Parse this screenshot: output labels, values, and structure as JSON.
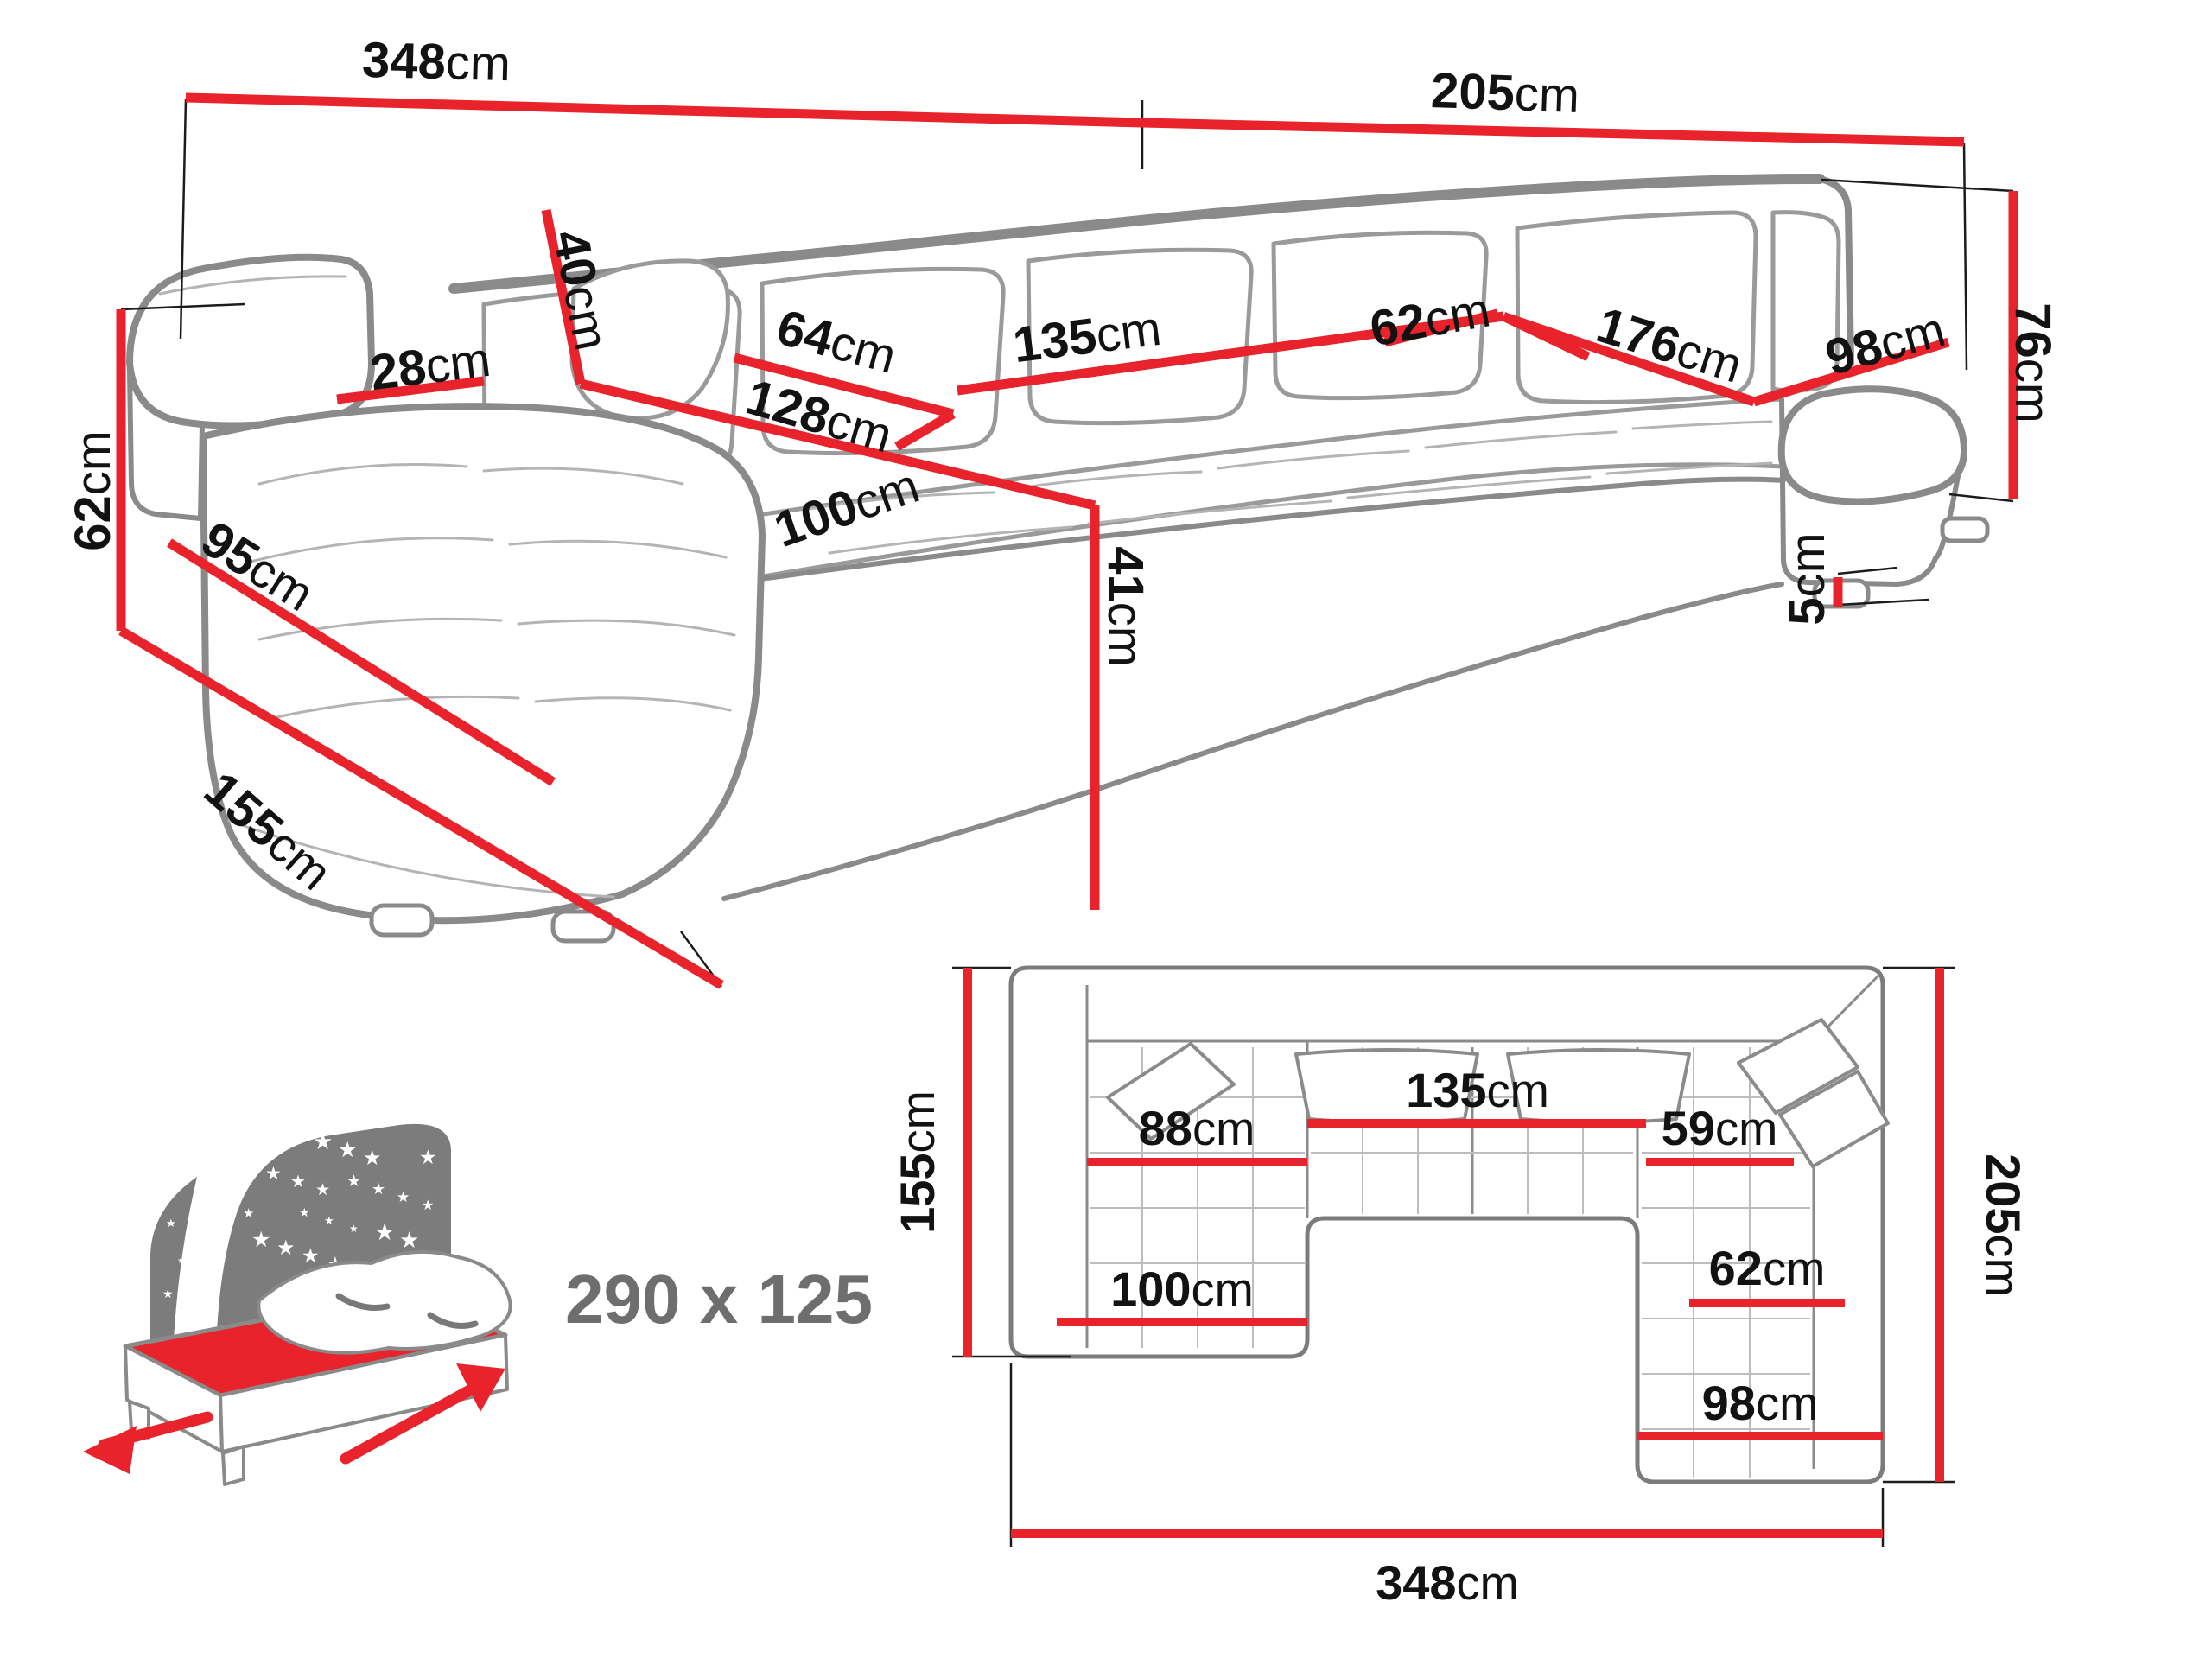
{
  "diagram": {
    "type": "corner-sofa-dimension-diagram",
    "accent_color": "#e8232b",
    "sketch_color": "#8a8a8a",
    "perspective": {
      "dims": [
        {
          "v": "348",
          "u": "cm"
        },
        {
          "v": "205",
          "u": "cm"
        },
        {
          "v": "76",
          "u": "cm"
        },
        {
          "v": "62",
          "u": "cm"
        },
        {
          "v": "95",
          "u": "cm"
        },
        {
          "v": "155",
          "u": "cm"
        },
        {
          "v": "28",
          "u": "cm"
        },
        {
          "v": "40",
          "u": "cm"
        },
        {
          "v": "64",
          "u": "cm"
        },
        {
          "v": "128",
          "u": "cm"
        },
        {
          "v": "135",
          "u": "cm"
        },
        {
          "v": "100",
          "u": "cm"
        },
        {
          "v": "41",
          "u": "cm"
        },
        {
          "v": "176",
          "u": "cm"
        },
        {
          "v": "62",
          "u": "cm"
        },
        {
          "v": "98",
          "u": "cm"
        },
        {
          "v": "5",
          "u": "cm"
        }
      ]
    },
    "plan": {
      "dims": [
        {
          "v": "155",
          "u": "cm"
        },
        {
          "v": "205",
          "u": "cm"
        },
        {
          "v": "348",
          "u": "cm"
        },
        {
          "v": "88",
          "u": "cm"
        },
        {
          "v": "135",
          "u": "cm"
        },
        {
          "v": "59",
          "u": "cm"
        },
        {
          "v": "62",
          "u": "cm"
        },
        {
          "v": "100",
          "u": "cm"
        },
        {
          "v": "98",
          "u": "cm"
        }
      ]
    },
    "sleeping_area": {
      "label": "290 x 125"
    }
  }
}
